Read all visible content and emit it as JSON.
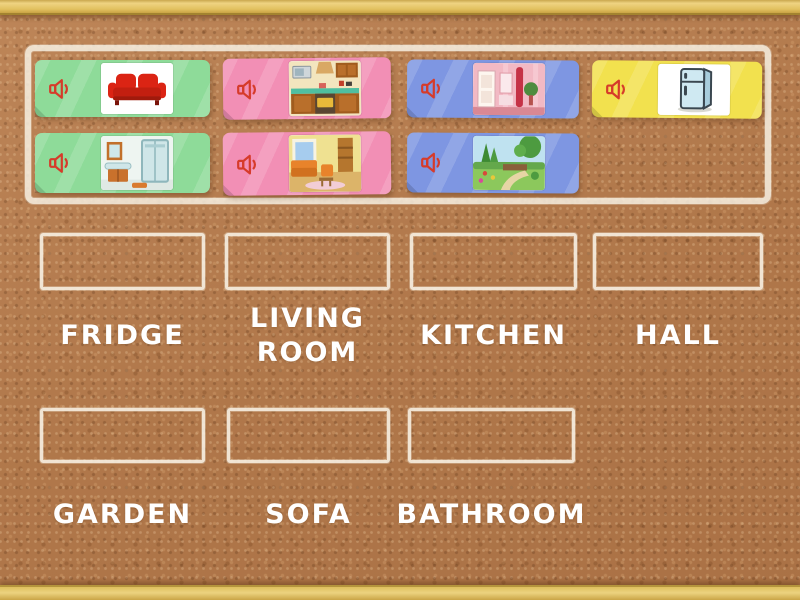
{
  "answer_zones": [
    {
      "label": "FRIDGE"
    },
    {
      "label": "LIVING ROOM"
    },
    {
      "label": "KITCHEN"
    },
    {
      "label": "HALL"
    },
    {
      "label": "GARDEN"
    },
    {
      "label": "SOFA"
    },
    {
      "label": "BATHROOM"
    }
  ],
  "audio_cards": [
    {
      "image": "red sofa",
      "card_color": "#8edb99",
      "icon": "speaker"
    },
    {
      "image": "kitchen",
      "card_color": "#f28fb5",
      "icon": "speaker"
    },
    {
      "image": "hall interior",
      "card_color": "#7e96e2",
      "icon": "speaker"
    },
    {
      "image": "fridge",
      "card_color": "#f2e14e",
      "icon": "speaker"
    },
    {
      "image": "bathroom",
      "card_color": "#8edb99",
      "icon": "speaker"
    },
    {
      "image": "living room",
      "card_color": "#f28fb5",
      "icon": "speaker"
    },
    {
      "image": "garden",
      "card_color": "#7e96e2",
      "icon": "speaker"
    }
  ],
  "colors": {
    "cork_background": "#b47c50",
    "wood_frame": "#e2c160",
    "chalk_outline": "#f5eddf",
    "card_green": "#8edb99",
    "card_pink": "#f28fb5",
    "card_blue": "#7e96e2",
    "card_yellow": "#f2e14e",
    "speaker_icon": "#d63b2a",
    "label_text": "#ffffff"
  }
}
